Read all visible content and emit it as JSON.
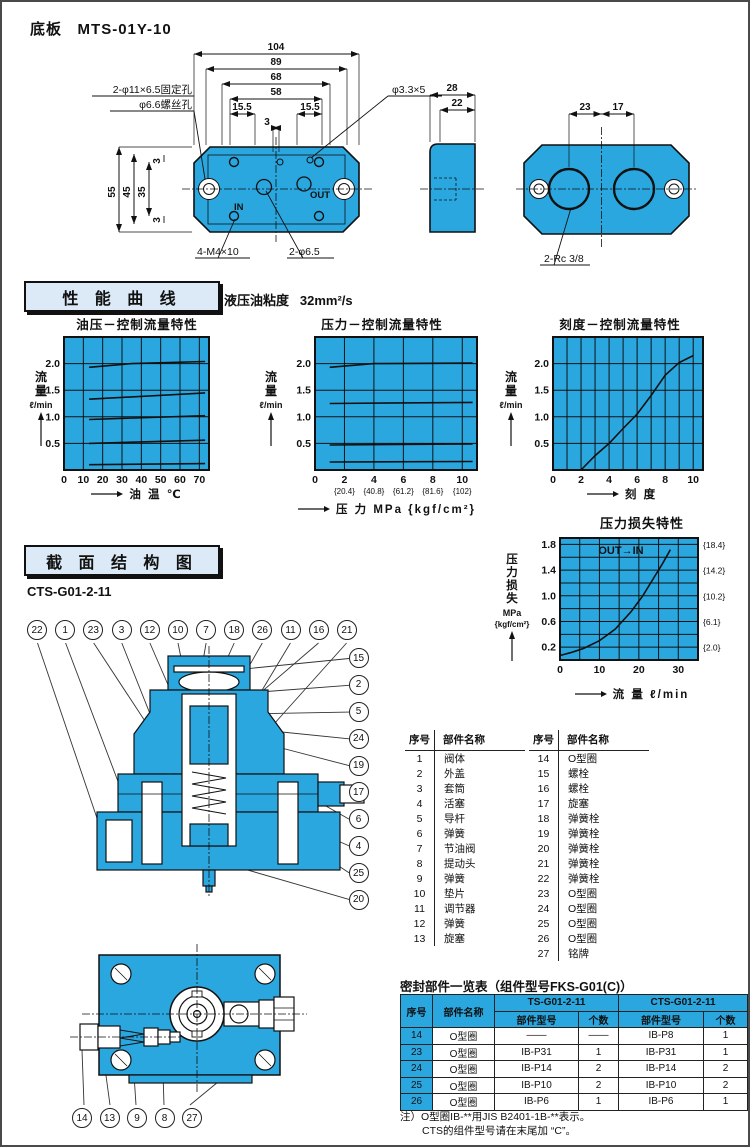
{
  "colors": {
    "blue": "#2BA7E0",
    "panel_bg": "#DCE9F6",
    "line": "#111111"
  },
  "header": {
    "title": "底板",
    "model": "MTS-01Y-10"
  },
  "base_plate": {
    "labels": {
      "fixing_hole": "2-φ11×6.5固定孔",
      "screw_hole": "φ6.6螺丝孔",
      "pin_hole": "φ3.3×5",
      "tap": "4-M4×10",
      "port": "2-φ6.5",
      "rc": "2-Rc 3/8",
      "port_in": "IN",
      "port_out": "OUT"
    },
    "dims": {
      "w104": "104",
      "w89": "89",
      "w68": "68",
      "w58": "58",
      "w155l": "15.5",
      "w155r": "15.5",
      "w3": "3",
      "h55": "55",
      "h45": "45",
      "h35": "35",
      "h3a": "3",
      "h3b": "3",
      "t28": "28",
      "t22": "22",
      "c23": "23",
      "c17": "17"
    }
  },
  "performance": {
    "section_title": "性 能 曲 线",
    "viscosity_label": "液压油粘度",
    "viscosity_value": "32mm²/s"
  },
  "structure": {
    "section_title": "截 面 结 构 图",
    "model": "CTS-G01-2-11",
    "balloons_top": [
      "22",
      "1",
      "23",
      "3",
      "12",
      "10",
      "7",
      "18",
      "26",
      "11",
      "16",
      "21"
    ],
    "balloons_right": [
      "15",
      "2",
      "5",
      "24",
      "19",
      "17",
      "6",
      "4",
      "25",
      "20"
    ],
    "balloons_bottom": [
      "14",
      "13",
      "9",
      "8",
      "27"
    ]
  },
  "parts_table": {
    "col_seq": "序号",
    "col_name": "部件名称",
    "left": [
      [
        "1",
        "阀体"
      ],
      [
        "2",
        "外盖"
      ],
      [
        "3",
        "套筒"
      ],
      [
        "4",
        "活塞"
      ],
      [
        "5",
        "导杆"
      ],
      [
        "6",
        "弹簧"
      ],
      [
        "7",
        "节油阀"
      ],
      [
        "8",
        "提动头"
      ],
      [
        "9",
        "弹簧"
      ],
      [
        "10",
        "垫片"
      ],
      [
        "11",
        "调节器"
      ],
      [
        "12",
        "弹簧"
      ],
      [
        "13",
        "旋塞"
      ]
    ],
    "right": [
      [
        "14",
        "O型圈"
      ],
      [
        "15",
        "螺栓"
      ],
      [
        "16",
        "螺栓"
      ],
      [
        "17",
        "旋塞"
      ],
      [
        "18",
        "弹簧栓"
      ],
      [
        "19",
        "弹簧栓"
      ],
      [
        "20",
        "弹簧栓"
      ],
      [
        "21",
        "弹簧栓"
      ],
      [
        "22",
        "弹簧栓"
      ],
      [
        "23",
        "O型圈"
      ],
      [
        "24",
        "O型圈"
      ],
      [
        "25",
        "O型圈"
      ],
      [
        "26",
        "O型圈"
      ],
      [
        "27",
        "铭牌"
      ]
    ]
  },
  "seal_table": {
    "title": "密封部件一览表（组件型号FKS-G01(C)）",
    "col_seq": "序号",
    "col_name": "部件名称",
    "group1": "TS-G01-2-11",
    "group2": "CTS-G01-2-11",
    "sub_model": "部件型号",
    "sub_qty": "个数",
    "rows": [
      [
        "14",
        "O型圈",
        "——",
        "——",
        "IB-P8",
        "1"
      ],
      [
        "23",
        "O型圈",
        "IB-P31",
        "1",
        "IB-P31",
        "1"
      ],
      [
        "24",
        "O型圈",
        "IB-P14",
        "2",
        "IB-P14",
        "2"
      ],
      [
        "25",
        "O型圈",
        "IB-P10",
        "2",
        "IB-P10",
        "2"
      ],
      [
        "26",
        "O型圈",
        "IB-P6",
        "1",
        "IB-P6",
        "1"
      ]
    ],
    "notes": [
      "注）O型圈IB-**用JIS B2401-1B-**表示。",
      "CTS的组件型号请在末尾加 “C”。"
    ]
  },
  "chart_data": [
    {
      "type": "line",
      "title": "油压－控制流量特性",
      "ylabel": "流量",
      "yunit": "ℓ/min",
      "xlabel": "油  温  ℃",
      "xlim": [
        0,
        75
      ],
      "ylim": [
        0,
        2.5
      ],
      "xgrid": 10,
      "ygrid": 0.5,
      "grid": true,
      "legend": "none",
      "xticks": [
        {
          "v": 0,
          "l": "0"
        },
        {
          "v": 10,
          "l": "10"
        },
        {
          "v": 20,
          "l": "20"
        },
        {
          "v": 30,
          "l": "30"
        },
        {
          "v": 40,
          "l": "40"
        },
        {
          "v": 50,
          "l": "50"
        },
        {
          "v": 60,
          "l": "60"
        },
        {
          "v": 70,
          "l": "70"
        }
      ],
      "yticks": [
        {
          "v": 0.5,
          "l": "0.5"
        },
        {
          "v": 1,
          "l": "1.0"
        },
        {
          "v": 1.5,
          "l": "1.5"
        },
        {
          "v": 2,
          "l": "2.0"
        }
      ],
      "series": [
        {
          "points": [
            [
              13,
              1.93
            ],
            [
              35,
              2.0
            ],
            [
              73,
              2.04
            ]
          ]
        },
        {
          "points": [
            [
              13,
              1.33
            ],
            [
              73,
              1.45
            ]
          ]
        },
        {
          "points": [
            [
              13,
              0.95
            ],
            [
              73,
              1.02
            ]
          ]
        },
        {
          "points": [
            [
              13,
              0.5
            ],
            [
              73,
              0.56
            ]
          ]
        },
        {
          "points": [
            [
              13,
              0.1
            ],
            [
              73,
              0.12
            ]
          ]
        }
      ]
    },
    {
      "type": "line",
      "title": "压力－控制流量特性",
      "ylabel": "流量",
      "yunit": "ℓ/min",
      "xlabel": "压  力  MPa {kgf/cm²}",
      "xlim": [
        0,
        11
      ],
      "ylim": [
        0,
        2.5
      ],
      "xgrid": 2,
      "ygrid": 0.5,
      "grid": true,
      "legend": "none",
      "xticks": [
        {
          "v": 0,
          "l": "0"
        },
        {
          "v": 2,
          "l": "2",
          "sub": "{20.4}"
        },
        {
          "v": 4,
          "l": "4",
          "sub": "{40.8}"
        },
        {
          "v": 6,
          "l": "6",
          "sub": "{61.2}"
        },
        {
          "v": 8,
          "l": "8",
          "sub": "{81.6}"
        },
        {
          "v": 10,
          "l": "10",
          "sub": "{102}"
        }
      ],
      "yticks": [
        {
          "v": 0.5,
          "l": "0.5"
        },
        {
          "v": 1,
          "l": "1.0"
        },
        {
          "v": 1.5,
          "l": "1.5"
        },
        {
          "v": 2,
          "l": "2.0"
        }
      ],
      "series": [
        {
          "points": [
            [
              1,
              1.93
            ],
            [
              4,
              2.0
            ],
            [
              10.7,
              2.01
            ]
          ]
        },
        {
          "points": [
            [
              1,
              1.25
            ],
            [
              10.7,
              1.27
            ]
          ]
        },
        {
          "points": [
            [
              1,
              0.47
            ],
            [
              10.7,
              0.49
            ]
          ]
        },
        {
          "points": [
            [
              1,
              0.15
            ],
            [
              10.7,
              0.16
            ]
          ]
        }
      ]
    },
    {
      "type": "line",
      "title": "刻度－控制流量特性",
      "ylabel": "流量",
      "yunit": "ℓ/min",
      "xlabel": "刻  度",
      "xlim": [
        0,
        10.7
      ],
      "ylim": [
        0,
        2.5
      ],
      "xgrid": 1,
      "ygrid": 0.5,
      "grid": true,
      "legend": "none",
      "xticks": [
        {
          "v": 0,
          "l": "0"
        },
        {
          "v": 2,
          "l": "2"
        },
        {
          "v": 4,
          "l": "4"
        },
        {
          "v": 6,
          "l": "6"
        },
        {
          "v": 8,
          "l": "8"
        },
        {
          "v": 10,
          "l": "10"
        }
      ],
      "yticks": [
        {
          "v": 0.5,
          "l": "0.5"
        },
        {
          "v": 1,
          "l": "1.0"
        },
        {
          "v": 1.5,
          "l": "1.5"
        },
        {
          "v": 2,
          "l": "2.0"
        }
      ],
      "series": [
        {
          "points": [
            [
              2,
              0
            ],
            [
              3,
              0.27
            ],
            [
              4,
              0.5
            ],
            [
              5,
              0.78
            ],
            [
              6,
              1.05
            ],
            [
              7,
              1.4
            ],
            [
              8,
              1.78
            ],
            [
              9,
              2.02
            ],
            [
              10,
              2.15
            ]
          ]
        }
      ]
    },
    {
      "type": "line",
      "title": "压力损失特性",
      "ylabel": "压力损失",
      "yunit": "MPa",
      "yunit2": "{kgf/cm²}",
      "xlabel": "流  量  ℓ/min",
      "annotation": "OUT→IN",
      "xlim": [
        0,
        35
      ],
      "ylim": [
        0,
        1.9
      ],
      "xgrid": 5,
      "ygrid": 0.2,
      "grid": true,
      "legend": "none",
      "xticks": [
        {
          "v": 0,
          "l": "0"
        },
        {
          "v": 10,
          "l": "10"
        },
        {
          "v": 20,
          "l": "20"
        },
        {
          "v": 30,
          "l": "30"
        }
      ],
      "yticks": [
        {
          "v": 0.2,
          "l": "0.2"
        },
        {
          "v": 0.6,
          "l": "0.6"
        },
        {
          "v": 1.0,
          "l": "1.0"
        },
        {
          "v": 1.4,
          "l": "1.4"
        },
        {
          "v": 1.8,
          "l": "1.8"
        }
      ],
      "right_ticks": [
        {
          "v": 1.8,
          "l": "{18.4}"
        },
        {
          "v": 1.4,
          "l": "{14.2}"
        },
        {
          "v": 1.0,
          "l": "{10.2}"
        },
        {
          "v": 0.6,
          "l": "{6.1}"
        },
        {
          "v": 0.2,
          "l": "{2.0}"
        }
      ],
      "series": [
        {
          "points": [
            [
              0,
              0.07
            ],
            [
              3,
              0.12
            ],
            [
              6,
              0.18
            ],
            [
              10,
              0.3
            ],
            [
              14,
              0.48
            ],
            [
              18,
              0.75
            ],
            [
              21,
              1.0
            ],
            [
              24,
              1.3
            ],
            [
              26,
              1.5
            ],
            [
              28,
              1.72
            ]
          ]
        }
      ]
    }
  ]
}
